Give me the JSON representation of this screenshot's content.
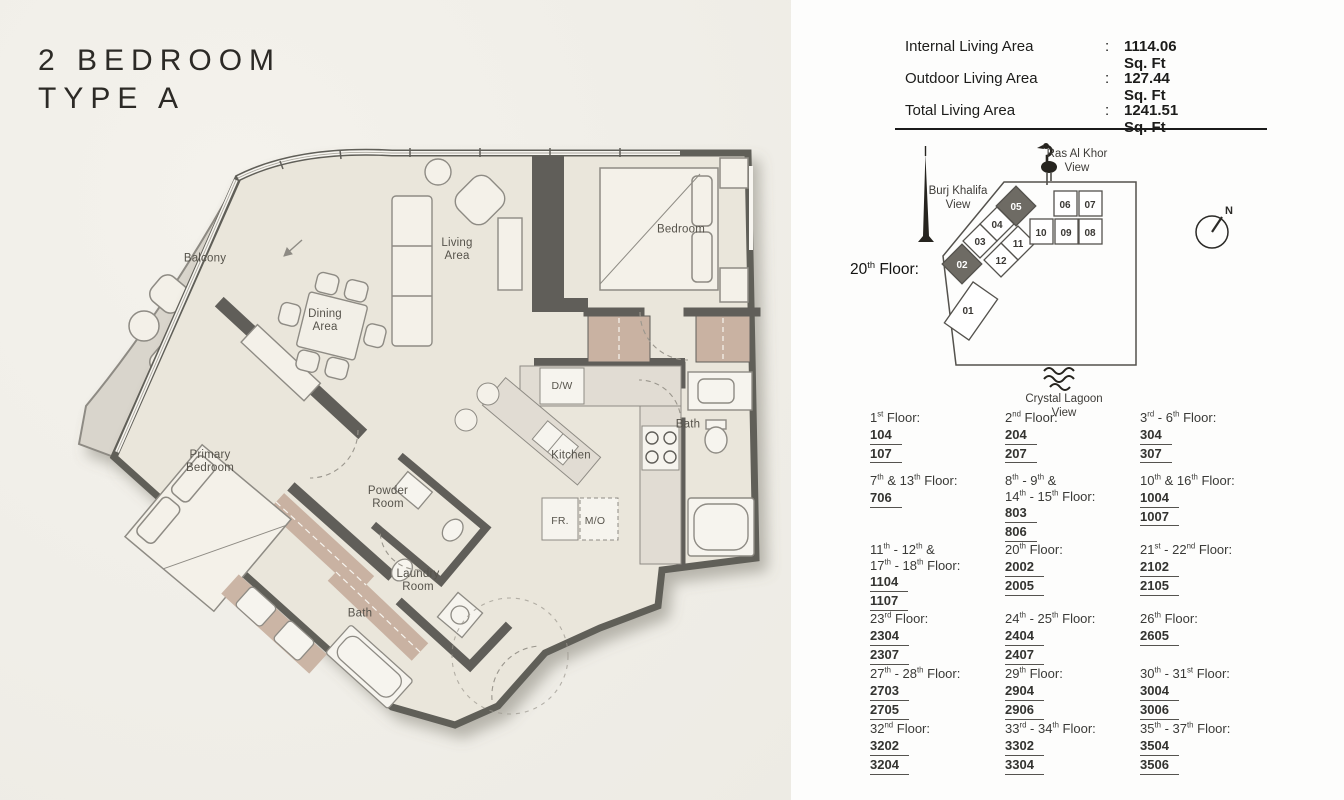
{
  "title": "2 BEDROOM\nTYPE A",
  "stats": {
    "colon": ":",
    "rows": [
      {
        "label": "Internal Living Area",
        "value": "1114.06 Sq. Ft"
      },
      {
        "label": "Outdoor Living Area",
        "value": "127.44 Sq. Ft"
      },
      {
        "label": "Total Living Area",
        "value": "1241.51 Sq. Ft"
      }
    ]
  },
  "key_plan": {
    "floor_label": [
      {
        "t": "20"
      },
      {
        "sup": "th"
      },
      {
        "t": " Floor:"
      }
    ],
    "views": {
      "ras": [
        "Ras Al Khor",
        "View"
      ],
      "burj": [
        "Burj Khalifa",
        "View"
      ],
      "lagoon": [
        "Crystal Lagoon",
        "View"
      ]
    },
    "compass": "N",
    "units": [
      "01",
      "02",
      "03",
      "04",
      "05",
      "06",
      "07",
      "08",
      "09",
      "10",
      "11",
      "12"
    ],
    "highlight_color": "#6e6b64"
  },
  "plan": {
    "rooms": {
      "balcony": "Balcony",
      "living": "Living\nArea",
      "dining": "Dining\nArea",
      "bedroom": "Bedroom",
      "primary": "Primary\nBedroom",
      "powder": "Powder\nRoom",
      "kitchen": "Kitchen",
      "bath1": "Bath",
      "bath2": "Bath",
      "laundry": "Laundry\nRoom",
      "dw": "D/W",
      "fr": "FR.",
      "mo": "M/O"
    }
  },
  "floors": {
    "cells": [
      {
        "label": [
          {
            "t": "1"
          },
          {
            "sup": "st"
          },
          {
            "t": " Floor:"
          }
        ],
        "units": [
          "104",
          "107"
        ]
      },
      {
        "label": [
          {
            "t": "2"
          },
          {
            "sup": "nd"
          },
          {
            "t": " Floor:"
          }
        ],
        "units": [
          "204",
          "207"
        ]
      },
      {
        "label": [
          {
            "t": "3"
          },
          {
            "sup": "rd"
          },
          {
            "t": " - 6"
          },
          {
            "sup": "th"
          },
          {
            "t": " Floor:"
          }
        ],
        "units": [
          "304",
          "307"
        ]
      },
      {
        "label": [
          {
            "t": "7"
          },
          {
            "sup": "th"
          },
          {
            "t": " & 13"
          },
          {
            "sup": "th"
          },
          {
            "t": " Floor:"
          }
        ],
        "units": [
          "706"
        ]
      },
      {
        "label": [
          {
            "t": "8"
          },
          {
            "sup": "th"
          },
          {
            "t": " - 9"
          },
          {
            "sup": "th"
          },
          {
            "t": " &"
          },
          {
            "br": true
          },
          {
            "t": "14"
          },
          {
            "sup": "th"
          },
          {
            "t": " - 15"
          },
          {
            "sup": "th"
          },
          {
            "t": " Floor:"
          }
        ],
        "units": [
          "803",
          "806"
        ]
      },
      {
        "label": [
          {
            "t": "10"
          },
          {
            "sup": "th"
          },
          {
            "t": " & 16"
          },
          {
            "sup": "th"
          },
          {
            "t": " Floor:"
          }
        ],
        "units": [
          "1004",
          "1007"
        ]
      },
      {
        "label": [
          {
            "t": "11"
          },
          {
            "sup": "th"
          },
          {
            "t": " - 12"
          },
          {
            "sup": "th"
          },
          {
            "t": " &"
          },
          {
            "br": true
          },
          {
            "t": "17"
          },
          {
            "sup": "th"
          },
          {
            "t": " - 18"
          },
          {
            "sup": "th"
          },
          {
            "t": " Floor:"
          }
        ],
        "units": [
          "1104",
          "1107"
        ]
      },
      {
        "label": [
          {
            "t": "20"
          },
          {
            "sup": "th"
          },
          {
            "t": " Floor:"
          }
        ],
        "units": [
          "2002",
          "2005"
        ]
      },
      {
        "label": [
          {
            "t": "21"
          },
          {
            "sup": "st"
          },
          {
            "t": " - 22"
          },
          {
            "sup": "nd"
          },
          {
            "t": " Floor:"
          }
        ],
        "units": [
          "2102",
          "2105"
        ]
      },
      {
        "label": [
          {
            "t": "23"
          },
          {
            "sup": "rd"
          },
          {
            "t": " Floor:"
          }
        ],
        "units": [
          "2304",
          "2307"
        ]
      },
      {
        "label": [
          {
            "t": "24"
          },
          {
            "sup": "th"
          },
          {
            "t": " - 25"
          },
          {
            "sup": "th"
          },
          {
            "t": " Floor:"
          }
        ],
        "units": [
          "2404",
          "2407"
        ]
      },
      {
        "label": [
          {
            "t": "26"
          },
          {
            "sup": "th"
          },
          {
            "t": " Floor:"
          }
        ],
        "units": [
          "2605"
        ]
      },
      {
        "label": [
          {
            "t": "27"
          },
          {
            "sup": "th"
          },
          {
            "t": " - 28"
          },
          {
            "sup": "th"
          },
          {
            "t": " Floor:"
          }
        ],
        "units": [
          "2703",
          "2705"
        ]
      },
      {
        "label": [
          {
            "t": "29"
          },
          {
            "sup": "th"
          },
          {
            "t": " Floor:"
          }
        ],
        "units": [
          "2904",
          "2906"
        ]
      },
      {
        "label": [
          {
            "t": "30"
          },
          {
            "sup": "th"
          },
          {
            "t": " - 31"
          },
          {
            "sup": "st"
          },
          {
            "t": " Floor:"
          }
        ],
        "units": [
          "3004",
          "3006"
        ]
      },
      {
        "label": [
          {
            "t": "32"
          },
          {
            "sup": "nd"
          },
          {
            "t": " Floor:"
          }
        ],
        "units": [
          "3202",
          "3204"
        ]
      },
      {
        "label": [
          {
            "t": "33"
          },
          {
            "sup": "rd"
          },
          {
            "t": " - 34"
          },
          {
            "sup": "th"
          },
          {
            "t": " Floor:"
          }
        ],
        "units": [
          "3302",
          "3304"
        ]
      },
      {
        "label": [
          {
            "t": "35"
          },
          {
            "sup": "th"
          },
          {
            "t": " - 37"
          },
          {
            "sup": "th"
          },
          {
            "t": " Floor:"
          }
        ],
        "units": [
          "3504",
          "3506"
        ]
      }
    ]
  }
}
